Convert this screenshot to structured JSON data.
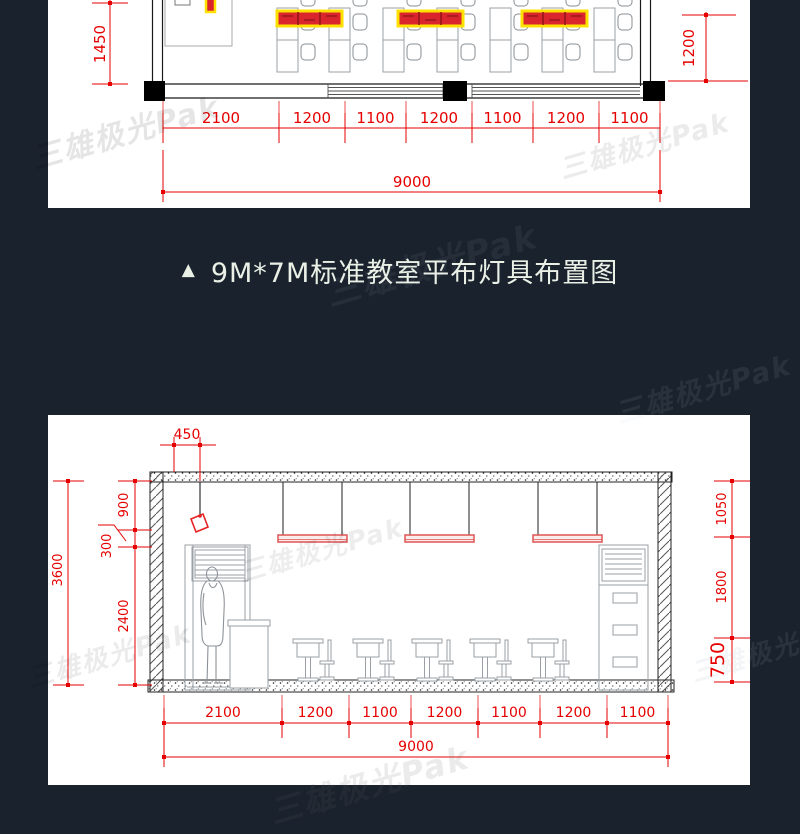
{
  "watermark_text": "三雄极光Pak",
  "caption": {
    "marker": "▲",
    "text": "9M*7M标准教室平布灯具布置图"
  },
  "plan_view": {
    "dim_left_vertical": "1450",
    "dim_right_vertical": "1200",
    "dims_bottom": [
      "2100",
      "1200",
      "1100",
      "1200",
      "1100",
      "1200",
      "1100"
    ],
    "dim_overall": "9000"
  },
  "section_view": {
    "dim_lamp_offset": "450",
    "dim_ceiling_to_lamp": "900",
    "dim_lamp_to_luminaire": "300",
    "dim_luminaire_to_floor": "2400",
    "dim_room_height": "3600",
    "dim_right_top": "1050",
    "dim_right_middle": "1800",
    "dim_right_bottom": "750",
    "dims_bottom": [
      "2100",
      "1200",
      "1100",
      "1200",
      "1100",
      "1200",
      "1100"
    ],
    "dim_overall": "9000"
  },
  "colors": {
    "background": "#1a222d",
    "dimension_red": "#e60000",
    "luminaire_red": "#d9252b",
    "luminaire_yellow": "#ffe100",
    "caption_text": "#eaf0e6"
  }
}
